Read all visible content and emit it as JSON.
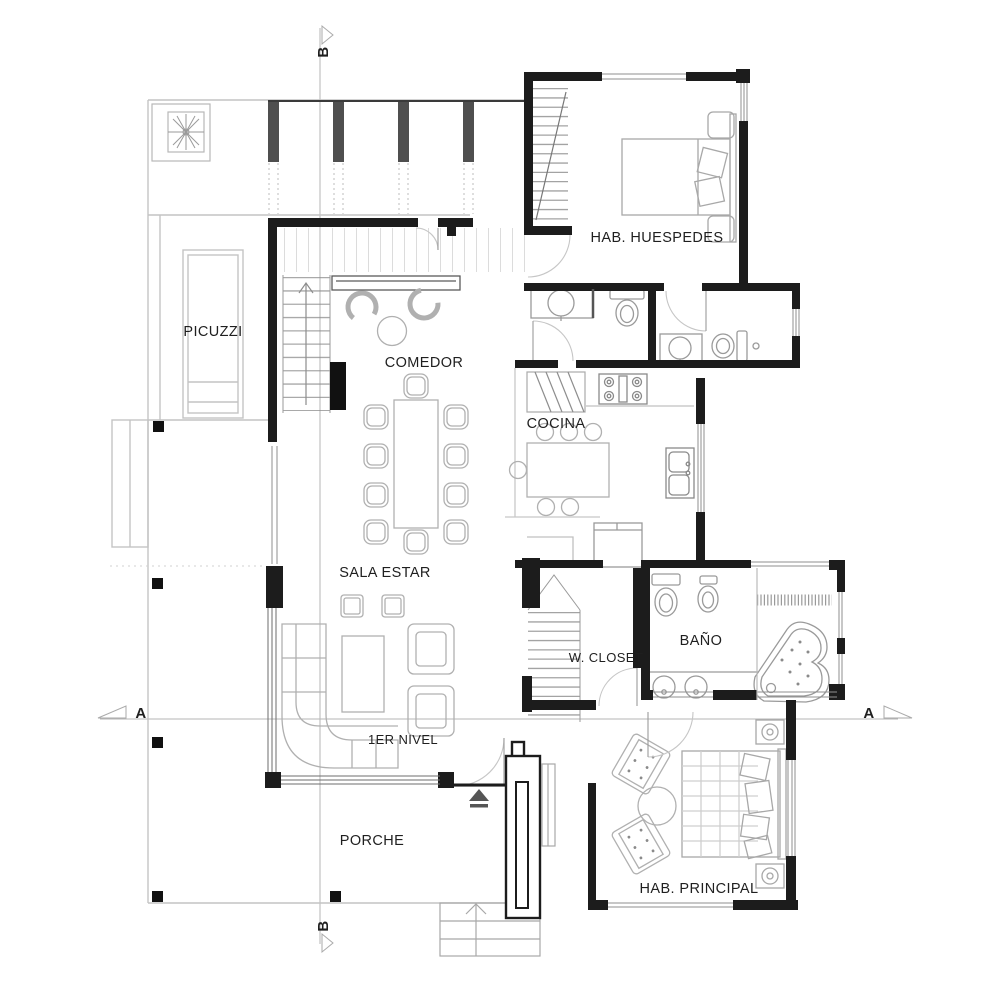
{
  "drawing": {
    "type": "architectural-floor-plan",
    "level_note": "1ER NIVEL"
  },
  "rooms": {
    "picuzzi": "PICUZZI",
    "comedor": "COMEDOR",
    "cocina": "COCINA",
    "hab_huespedes": "HAB. HUESPEDES",
    "sala_estar": "SALA ESTAR",
    "w_closet": "W. CLOSET",
    "bano": "BAÑO",
    "porche": "PORCHE",
    "hab_principal": "HAB. PRINCIPAL"
  },
  "sections": {
    "a": "A",
    "b": "B"
  },
  "colors": {
    "wall": "#1c1c1c",
    "column_gray": "#4f4f4f",
    "furniture_line": "#b0b0b0",
    "terrace_line": "#c4c4c4",
    "section_line": "#b5b5b5",
    "background": "#ffffff"
  }
}
